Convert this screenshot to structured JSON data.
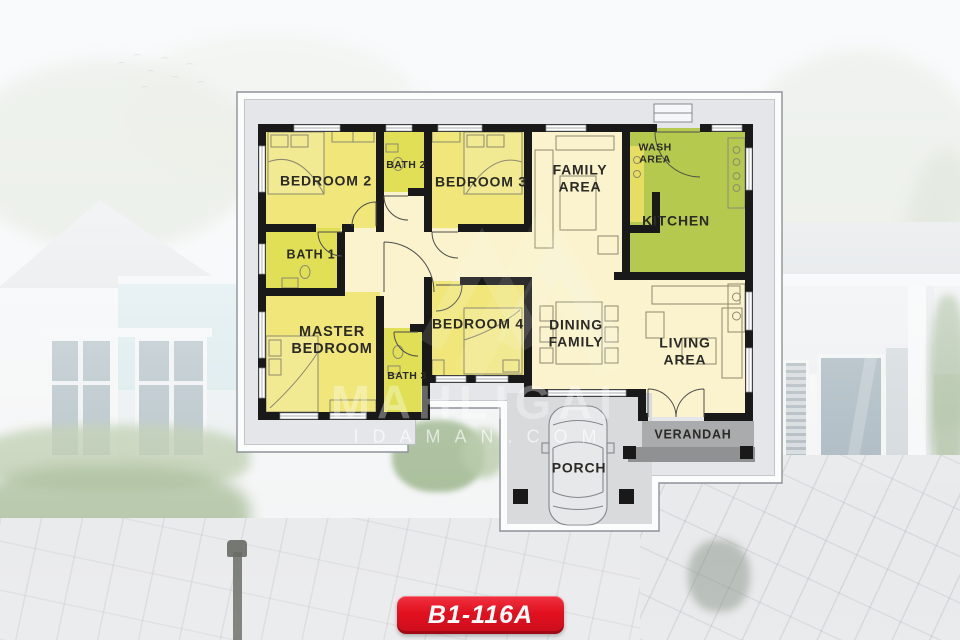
{
  "watermark": {
    "brand": "MAHLIGAI",
    "site": "IDAMAN.COM"
  },
  "badge": {
    "label": "B1-116A",
    "color": "#e2101f"
  },
  "floor_plan": {
    "rooms": {
      "bedroom2": {
        "label": "BEDROOM 2"
      },
      "bath2": {
        "label": "BATH 2"
      },
      "bedroom3": {
        "label": "BEDROOM 3"
      },
      "family": {
        "line1": "FAMILY",
        "line2": "AREA"
      },
      "wash": {
        "line1": "WASH",
        "line2": "AREA"
      },
      "kitchen": {
        "label": "KITCHEN"
      },
      "bath1": {
        "label": "BATH 1"
      },
      "master": {
        "line1": "MASTER",
        "line2": "BEDROOM"
      },
      "bedroom4": {
        "label": "BEDROOM 4"
      },
      "bath3": {
        "label": "BATH 3"
      },
      "dining": {
        "line1": "DINING",
        "line2": "FAMILY"
      },
      "living": {
        "line1": "LIVING",
        "line2": "AREA"
      },
      "verandah": {
        "label": "VERANDAH"
      },
      "porch": {
        "label": "PORCH"
      }
    },
    "colors": {
      "bedroom": "#f0e67a",
      "bath": "#e0df55",
      "kitchen": "#b5c94f",
      "hall": "#faf3cd",
      "wall": "#191919",
      "panel": "#e4e6e9",
      "verandah": "#a9abac",
      "porch": "#d8dadc"
    }
  }
}
